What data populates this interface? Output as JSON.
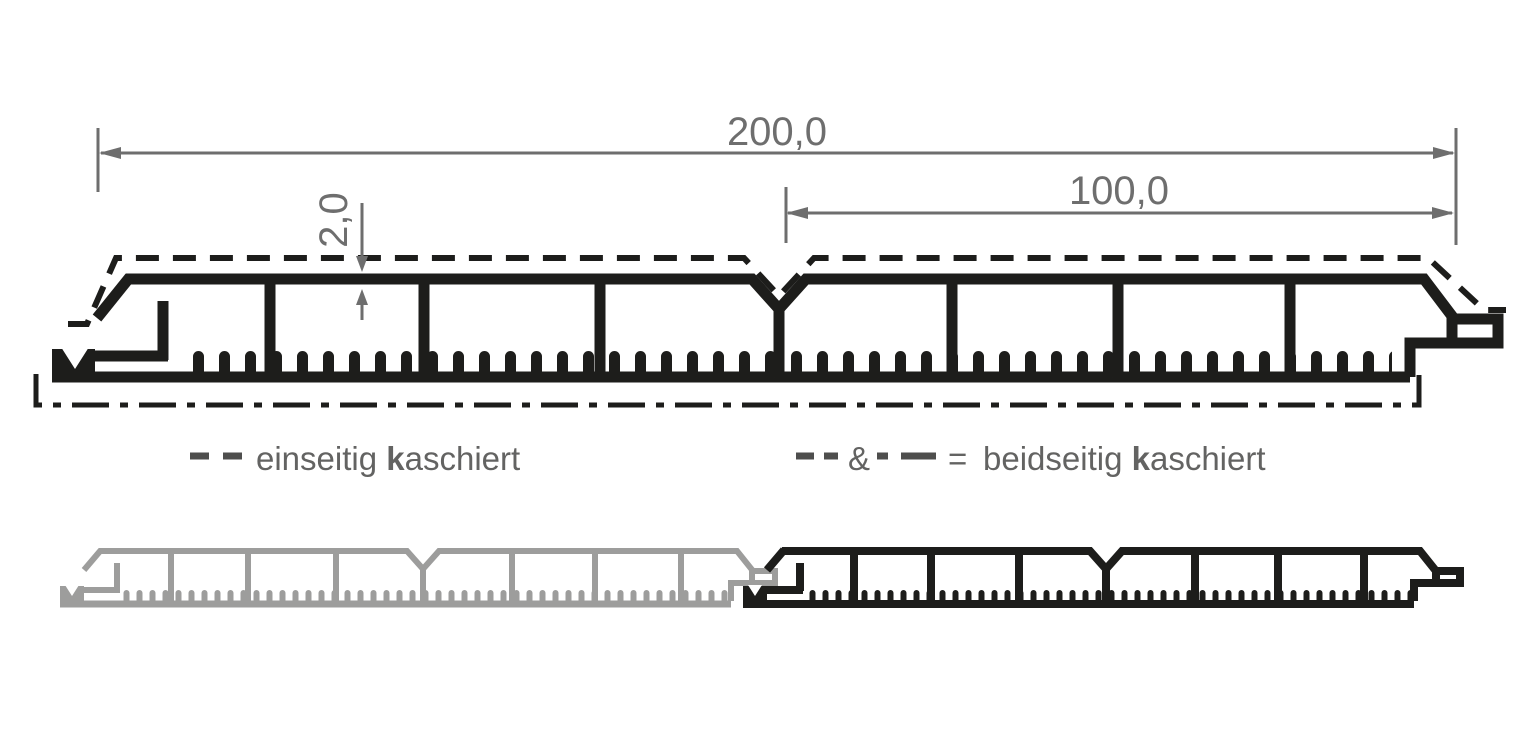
{
  "diagram": {
    "description": "Technical cross-section of a tongue-and-groove cladding panel profile with lamination legend",
    "dims": {
      "total": "200,0",
      "half": "100,0",
      "thickness": "2,0"
    },
    "legend": {
      "left": {
        "symbol": "dashed-line",
        "normal1": "einseitig ",
        "bold": "k",
        "normal2": "aschiert"
      },
      "right": {
        "symbol_dashed": "dashed-line",
        "amp": "&",
        "symbol_dashdot": "dash-dot-line",
        "equals": "=",
        "normal1": "beidseitig ",
        "bold": "k",
        "normal2": "aschiert"
      }
    },
    "colors": {
      "line": "#1d1d1b",
      "gray": "#9d9d9c",
      "dim": "#6e6e6e",
      "legend": "#636362",
      "bg": "#ffffff"
    }
  }
}
